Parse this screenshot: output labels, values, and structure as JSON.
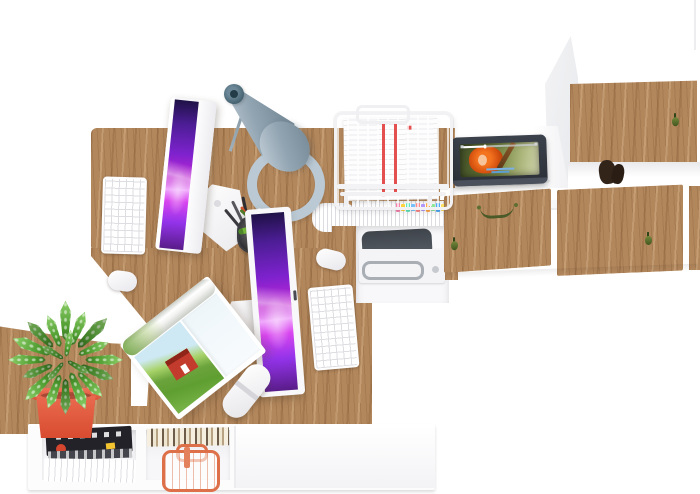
{
  "scene": {
    "description": "Top-down view of a home office: oak corner desk with two iMac workstations, white keyboards and mice, gray desk lamp, wire document tray with papers, tablet playing an animated movie, printer shelf, white-and-oak cabinet wall, open magazine, succulent in a red pot and a low white shelf with magazines and a copper basket."
  },
  "palette": {
    "wood": "#b3875c",
    "wood_dark": "#8f6840",
    "wood_light": "#cda176",
    "panel_white": "#fbfbfd",
    "panel_shadow": "#e9e9ee",
    "screen_deep": "#4c1d95",
    "screen_bright": "#e879f9",
    "lamp_light": "#bcc9d3",
    "lamp_mid": "#92a5b2",
    "lamp_dark": "#44616f",
    "pot": "#d84c30",
    "pot_light": "#ef7257",
    "leaf_light": "#8ed06a",
    "leaf_dark": "#4c9a2e",
    "tablet_frame": "#343a44",
    "slate": "#474c52",
    "chrome": "#a9aeb5",
    "copper": "#dd7048",
    "red_stripe": "#e45050",
    "red_accent": "#d6452e",
    "handle_green": "#4a5a28",
    "caption_blue": "#7ab2e8",
    "magazine_dark": "#222228",
    "sky": "#cfe9f4",
    "field_green": "#5f9e31",
    "house_red": "#c23b2c",
    "hair_orange": "#d4500f"
  },
  "objects": {
    "desk": "oak corner desk",
    "side_table": "oak side bench",
    "monitor_left": "iMac display (workstation 1)",
    "monitor_right": "iMac display (workstation 2)",
    "keyboard_left": "white wireless keyboard",
    "keyboard_right": "white wireless keyboard",
    "mouse_left": "white mouse",
    "mouse_right": "white mouse",
    "lamp": "gray desk lamp",
    "document_tray": "white wire document tray with papers",
    "tablet": "tablet playing animated movie",
    "printer": "printer on under-desk shelf",
    "tall_cabinet": "tall white cabinet with oak door",
    "cabinet_row": "oak-front cabinet row",
    "plant": "succulent in red pot",
    "magazine": "open magazine with countryside photo",
    "remote": "white remote control",
    "shelf_unit": "low white shelf with magazines and copper basket",
    "sticky_tabs": "colored index tabs",
    "pen_cup": "pen cup with markers",
    "figurine": "dark figurine on cabinet shelf"
  },
  "tablet_ui": {
    "video_progress": 0.3,
    "has_caption": true
  },
  "sticky_tab_colors": [
    "#f783ac",
    "#ffd43b",
    "#63e6be",
    "#74c0fc",
    "#ff8787",
    "#b197fc",
    "#ffa94d",
    "#8ce99a",
    "#4dabf7",
    "#ffe066",
    "#f06595",
    "#69db7c"
  ],
  "pen_colors": [
    "#3a3a3e",
    "#57575c",
    "#2e2e33",
    "#d4552e",
    "#e8e8ea",
    "#4f7d2a"
  ]
}
